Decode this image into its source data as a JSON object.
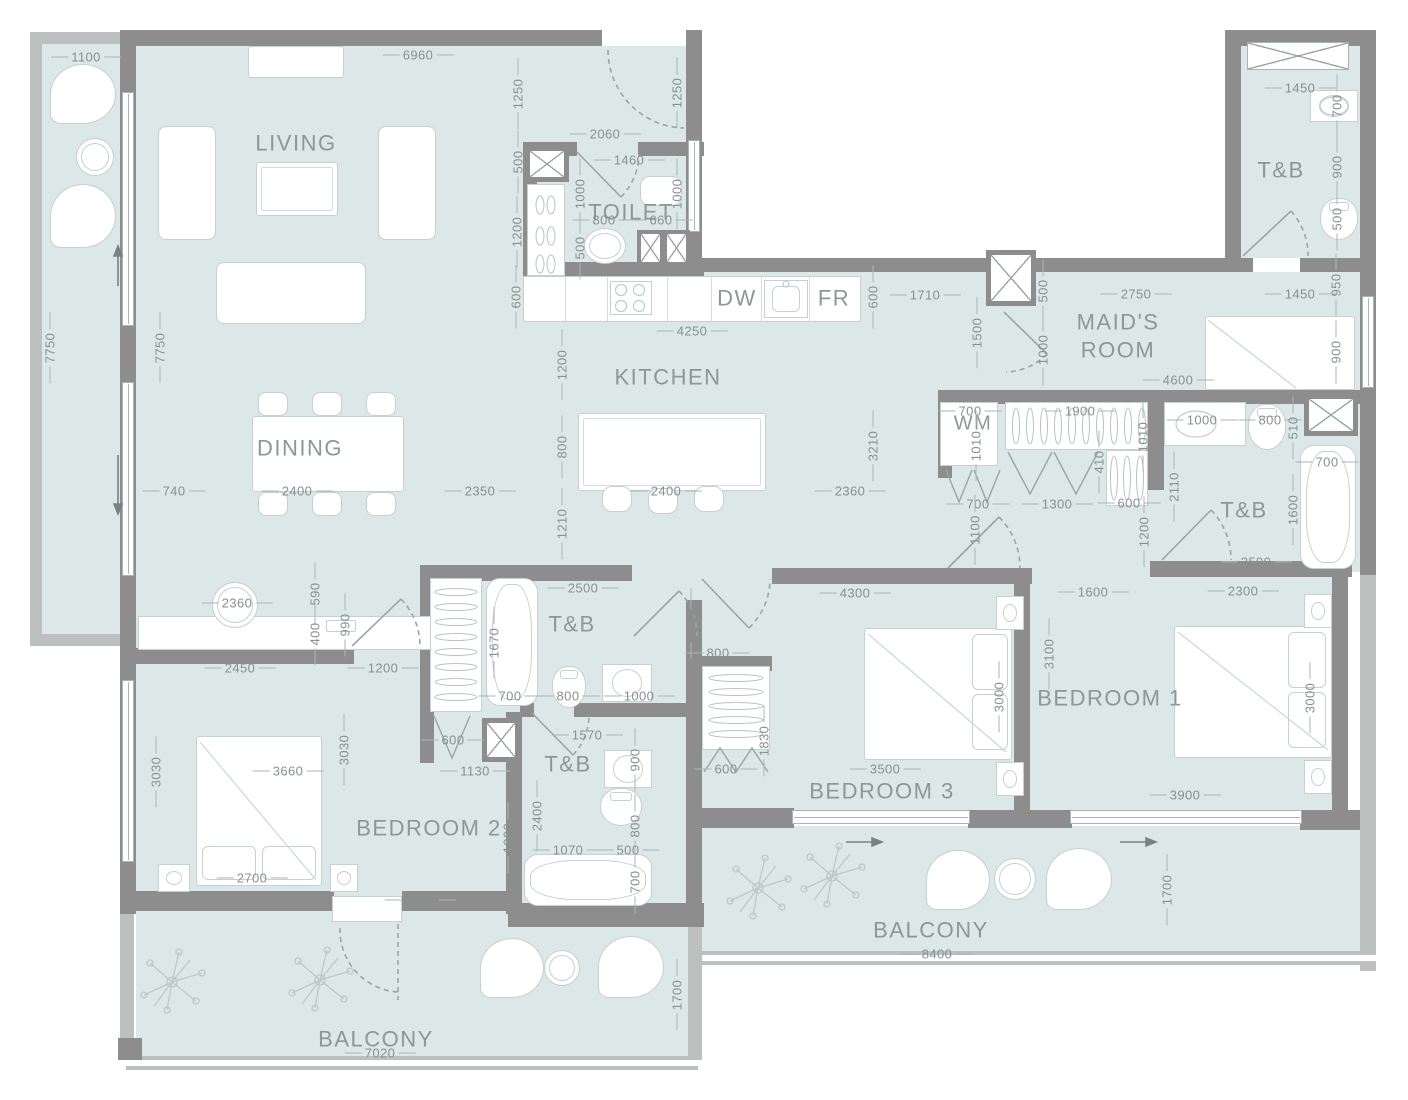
{
  "colors": {
    "floor": "#dbe8e7",
    "wall": "#8d8d8d",
    "wall_light": "#bcc0bf",
    "line": "#a9b5b3",
    "room_text": "#8c9896",
    "dim_text": "#87918f"
  },
  "rooms": [
    {
      "label": "LIVING",
      "x": 296,
      "y": 143
    },
    {
      "label": "TOILET",
      "x": 631,
      "y": 212
    },
    {
      "label": "KITCHEN",
      "x": 668,
      "y": 377
    },
    {
      "label": "DINING",
      "x": 300,
      "y": 448
    },
    {
      "label": "MAID'S ROOM",
      "x": 1118,
      "y": 336,
      "w": 110
    },
    {
      "label": "T&B",
      "x": 1281,
      "y": 170
    },
    {
      "label": "T&B",
      "x": 1244,
      "y": 510
    },
    {
      "label": "T&B",
      "x": 572,
      "y": 624
    },
    {
      "label": "T&B",
      "x": 568,
      "y": 764
    },
    {
      "label": "BEDROOM 1",
      "x": 1110,
      "y": 698
    },
    {
      "label": "BEDROOM 2",
      "x": 429,
      "y": 828
    },
    {
      "label": "BEDROOM 3",
      "x": 882,
      "y": 791
    },
    {
      "label": "BALCONY",
      "x": 376,
      "y": 1039
    },
    {
      "label": "BALCONY",
      "x": 931,
      "y": 930
    },
    {
      "label": "DW",
      "x": 737,
      "y": 298
    },
    {
      "label": "FR",
      "x": 834,
      "y": 298
    },
    {
      "label": "WM",
      "x": 973,
      "y": 424,
      "fs": 20
    }
  ],
  "dimensions": [
    [
      "1100",
      86,
      57,
      "h"
    ],
    [
      "6960",
      418,
      55,
      "h"
    ],
    [
      "7750",
      50,
      348,
      "v"
    ],
    [
      "7750",
      160,
      348,
      "v"
    ],
    [
      "1250",
      518,
      94,
      "v"
    ],
    [
      "2060",
      605,
      134,
      "h"
    ],
    [
      "1250",
      677,
      93,
      "v"
    ],
    [
      "500",
      518,
      162,
      "v"
    ],
    [
      "1460",
      629,
      160,
      "h"
    ],
    [
      "1000",
      580,
      194,
      "v"
    ],
    [
      "1000",
      677,
      194,
      "v"
    ],
    [
      "800",
      604,
      220,
      "h"
    ],
    [
      "660",
      661,
      220,
      "h"
    ],
    [
      "1200",
      517,
      232,
      "v"
    ],
    [
      "500",
      580,
      248,
      "v"
    ],
    [
      "600",
      516,
      297,
      "v"
    ],
    [
      "4250",
      692,
      331,
      "h"
    ],
    [
      "600",
      873,
      297,
      "v"
    ],
    [
      "1710",
      925,
      295,
      "h"
    ],
    [
      "1500",
      977,
      333,
      "v"
    ],
    [
      "500",
      1043,
      291,
      "v"
    ],
    [
      "2750",
      1136,
      294,
      "h"
    ],
    [
      "1450",
      1300,
      294,
      "h"
    ],
    [
      "950",
      1336,
      285,
      "v"
    ],
    [
      "1450",
      1300,
      88,
      "h"
    ],
    [
      "700",
      1337,
      106,
      "v"
    ],
    [
      "900",
      1337,
      167,
      "v"
    ],
    [
      "500",
      1337,
      219,
      "v"
    ],
    [
      "1000",
      1043,
      350,
      "v"
    ],
    [
      "4600",
      1178,
      380,
      "h"
    ],
    [
      "900",
      1336,
      352,
      "v"
    ],
    [
      "700",
      970,
      411,
      "h"
    ],
    [
      "1010",
      976,
      446,
      "v"
    ],
    [
      "1900",
      1080,
      411,
      "h"
    ],
    [
      "1010",
      1143,
      437,
      "v"
    ],
    [
      "410",
      1099,
      462,
      "v"
    ],
    [
      "1000",
      1202,
      420,
      "h"
    ],
    [
      "800",
      1270,
      420,
      "h"
    ],
    [
      "510",
      1293,
      428,
      "v"
    ],
    [
      "700",
      1327,
      462,
      "h"
    ],
    [
      "2110",
      1174,
      487,
      "v"
    ],
    [
      "1600",
      1293,
      510,
      "v"
    ],
    [
      "700",
      978,
      504,
      "h"
    ],
    [
      "1300",
      1057,
      504,
      "h"
    ],
    [
      "600",
      1129,
      503,
      "h"
    ],
    [
      "1100",
      975,
      530,
      "v"
    ],
    [
      "1200",
      1144,
      532,
      "v"
    ],
    [
      "2500",
      1256,
      562,
      "h"
    ],
    [
      "1200",
      562,
      365,
      "v"
    ],
    [
      "800",
      562,
      447,
      "v"
    ],
    [
      "2350",
      480,
      491,
      "h"
    ],
    [
      "2400",
      666,
      491,
      "h"
    ],
    [
      "2360",
      850,
      491,
      "h"
    ],
    [
      "3210",
      873,
      446,
      "v"
    ],
    [
      "1210",
      562,
      524,
      "v"
    ],
    [
      "740",
      174,
      491,
      "h"
    ],
    [
      "2400",
      297,
      491,
      "h"
    ],
    [
      "2360",
      237,
      603,
      "h"
    ],
    [
      "590",
      315,
      594,
      "v"
    ],
    [
      "400",
      315,
      634,
      "v"
    ],
    [
      "990",
      345,
      625,
      "v"
    ],
    [
      "2450",
      240,
      668,
      "h"
    ],
    [
      "1200",
      383,
      668,
      "h"
    ],
    [
      "2500",
      583,
      588,
      "h"
    ],
    [
      "1670",
      494,
      643,
      "v"
    ],
    [
      "1070",
      691,
      624,
      "v"
    ],
    [
      "800",
      718,
      653,
      "h"
    ],
    [
      "700",
      510,
      696,
      "h"
    ],
    [
      "800",
      568,
      696,
      "h"
    ],
    [
      "1000",
      639,
      696,
      "h"
    ],
    [
      "600",
      453,
      740,
      "h"
    ],
    [
      "1130",
      475,
      771,
      "h"
    ],
    [
      "1570",
      587,
      735,
      "h"
    ],
    [
      "900",
      635,
      760,
      "v"
    ],
    [
      "2400",
      537,
      816,
      "v"
    ],
    [
      "1900",
      508,
      838,
      "v"
    ],
    [
      "800",
      635,
      826,
      "v"
    ],
    [
      "1070",
      568,
      850,
      "h"
    ],
    [
      "500",
      628,
      850,
      "h"
    ],
    [
      "700",
      635,
      882,
      "v"
    ],
    [
      "600",
      726,
      769,
      "h"
    ],
    [
      "1830",
      764,
      741,
      "v"
    ],
    [
      "3030",
      156,
      772,
      "v"
    ],
    [
      "3030",
      344,
      750,
      "v"
    ],
    [
      "3660",
      288,
      771,
      "h"
    ],
    [
      "2700",
      252,
      878,
      "h"
    ],
    [
      "2080",
      420,
      900,
      "h"
    ],
    [
      "4300",
      855,
      593,
      "h"
    ],
    [
      "1600",
      1093,
      592,
      "h"
    ],
    [
      "2300",
      1243,
      591,
      "h"
    ],
    [
      "3100",
      1049,
      654,
      "v"
    ],
    [
      "3000",
      999,
      697,
      "v"
    ],
    [
      "3500",
      885,
      769,
      "h"
    ],
    [
      "3000",
      1310,
      698,
      "v"
    ],
    [
      "3900",
      1185,
      795,
      "h"
    ],
    [
      "1700",
      1167,
      890,
      "v"
    ],
    [
      "8400",
      937,
      954,
      "h"
    ],
    [
      "1700",
      677,
      995,
      "v"
    ],
    [
      "7020",
      380,
      1053,
      "h"
    ]
  ]
}
